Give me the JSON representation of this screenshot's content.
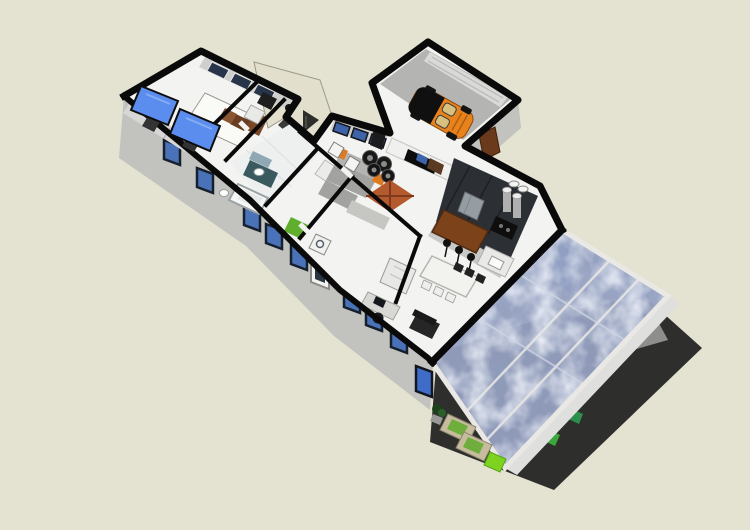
{
  "scene": {
    "kind": "3d-floor-plan-model-viewport",
    "view": "aerial cutaway perspective, building rotated diagonally",
    "background": "#e4e2d1"
  },
  "colors": {
    "background": "#e4e2d1",
    "wall_cap": "#0a0a0a",
    "wall_face": "#c2c2bf",
    "floor": "#f3f3f1",
    "tile": "#eef0f0",
    "garage_floor": "#b4b4b2",
    "entry_roof": "#e2dfcc",
    "window_frame": "#16202c",
    "window_glass": "#4a72b8",
    "glass_roof": "#97a3c4",
    "glass_beam": "#e9e8e4",
    "deck": "#2e2e2c",
    "tv_screen": "#5b8dee",
    "bed_white": "#fafaf7",
    "headboard": "#7a4726",
    "car_body": "#e8821c",
    "car_glass": "#101010",
    "car_seat": "#d9c07e",
    "rug": "#b55a2e",
    "sofa": "#a2a2a0",
    "tire": "#181818",
    "cabinet_dark": "#2c3034",
    "counter": "#c9c9c7",
    "bar_wood": "#7c4219",
    "stainless": "#969da2",
    "lounger": "#c7bd9e",
    "lounger_cushion": "#6fae3c",
    "side_table_green": "#7ed321",
    "laundry_green": "#5fae2e",
    "door_wood": "#6b3a1c"
  },
  "parts": [
    {
      "name": "bedroom",
      "items": [
        "bed",
        "headboard",
        "pillows",
        "tilted-tv-panels",
        "dresser",
        "back-windows"
      ]
    },
    {
      "name": "bathroom",
      "items": [
        "bathtub",
        "vanity",
        "mirror",
        "toilet",
        "tile-floor"
      ]
    },
    {
      "name": "laundry-room",
      "items": [
        "green-bin",
        "washer",
        "cabinets"
      ]
    },
    {
      "name": "office",
      "items": [
        "desk",
        "monitor",
        "task-chair",
        "shelving",
        "armchair"
      ]
    },
    {
      "name": "living-room",
      "items": [
        "sectional-sofa",
        "tire-coffee-tables",
        "rust-rug",
        "media-wall-tv",
        "speakers",
        "windows"
      ]
    },
    {
      "name": "kitchen",
      "items": [
        "dark-cabinets",
        "fridge",
        "cooktop",
        "canisters",
        "bar-counter",
        "bar-stools"
      ]
    },
    {
      "name": "dining-area",
      "items": [
        "long-table",
        "chairs"
      ]
    },
    {
      "name": "entry",
      "items": [
        "flat-roof",
        "gable"
      ]
    },
    {
      "name": "garage",
      "items": [
        "orange-convertible",
        "garage-door",
        "wood-door"
      ]
    },
    {
      "name": "patio",
      "items": [
        "mottled-glass-roof",
        "blue-cabinet",
        "under-glass-furniture"
      ]
    },
    {
      "name": "outdoor-deck",
      "items": [
        "tan-loungers",
        "green-side-table",
        "plant",
        "bench"
      ]
    }
  ]
}
